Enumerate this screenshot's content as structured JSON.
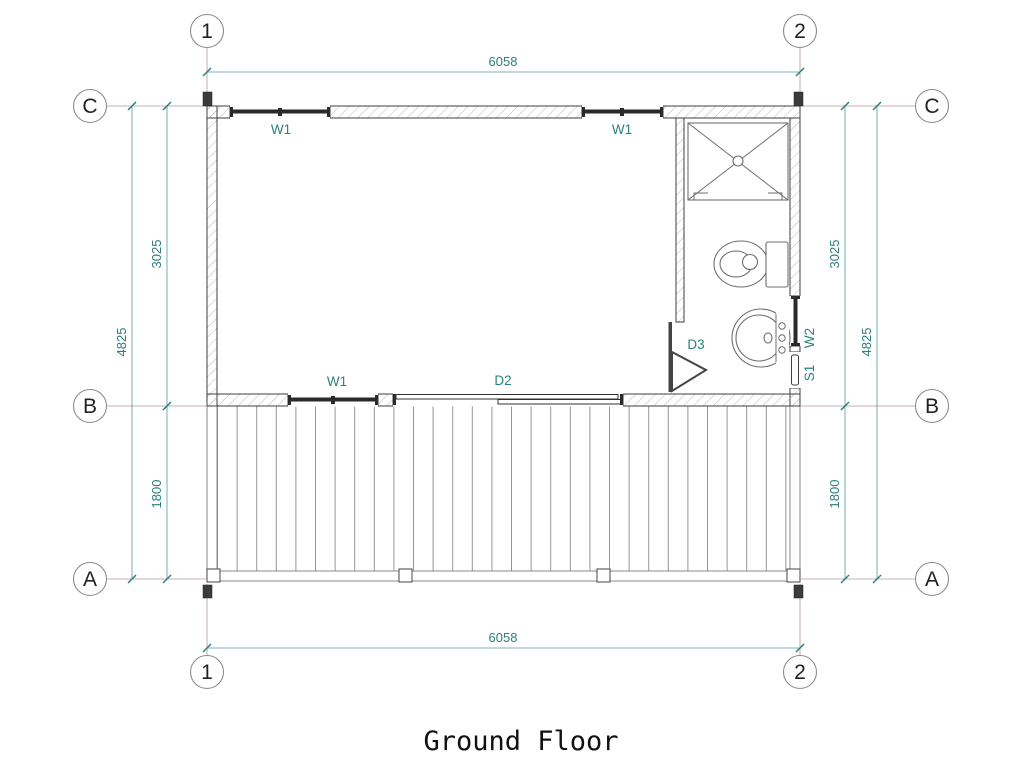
{
  "title": "Ground Floor",
  "colors": {
    "dimension": "#2b7f7f",
    "grid_line": "#b39a93",
    "wall": "#3f3f3f",
    "hatch": "#a8a8a8",
    "deck_line": "#8a8a8a",
    "fixture": "#6f6f6f",
    "window_frame": "#2a2a2a",
    "circle_stroke": "#8c8c8c"
  },
  "grid": {
    "column_1": "1",
    "column_2": "2",
    "row_a": "A",
    "row_b": "B",
    "row_c": "C"
  },
  "dimensions": {
    "top_width": "6058",
    "bottom_width": "6058",
    "left_room_depth": "3025",
    "left_total_depth": "4825",
    "left_deck_depth": "1800",
    "right_room_depth": "3025",
    "right_total_depth": "4825",
    "right_deck_depth": "1800"
  },
  "labels": {
    "window_top_left": "W1",
    "window_top_right": "W1",
    "window_bottom": "W1",
    "sliding_door": "D2",
    "bathroom_door": "D3",
    "right_window": "W2",
    "service_hatch": "S1"
  }
}
